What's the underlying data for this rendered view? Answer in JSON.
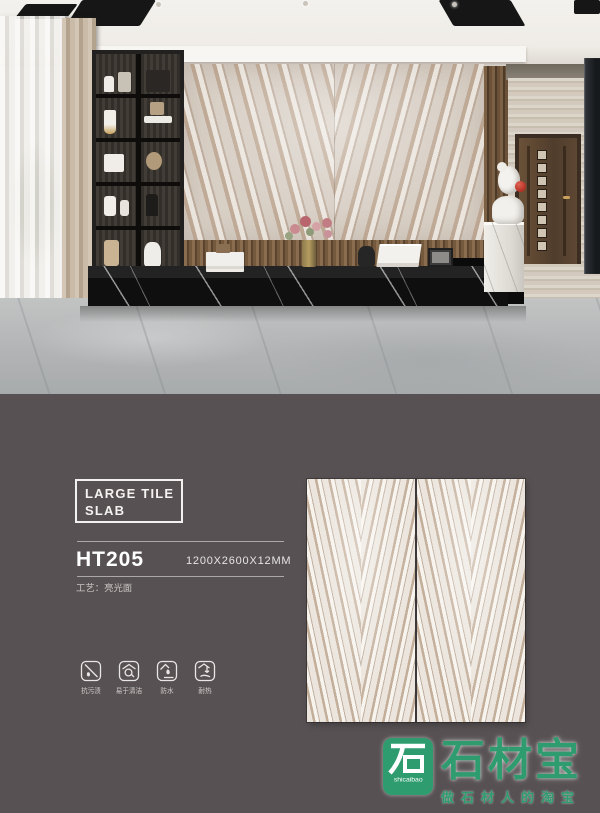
{
  "colors": {
    "panel_background": "#575153",
    "brand_green": "#2e9c6f",
    "text_white": "#f4f3f1",
    "marble_beige": "#d8cfc5",
    "bench_black": "#0f0f0f"
  },
  "product": {
    "series_line1": "LARGE TILE",
    "series_line2": "SLAB",
    "model": "HT205",
    "size": "1200X2600X12MM",
    "process": "工艺：亮光面"
  },
  "features": [
    {
      "name": "anti-stain",
      "label": "抗污渍"
    },
    {
      "name": "easy-clean",
      "label": "易于清洁"
    },
    {
      "name": "waterproof",
      "label": "防水"
    },
    {
      "name": "heat-resistant",
      "label": "耐热"
    }
  ],
  "brand": {
    "name": "石材宝",
    "latin": "shicaibao",
    "tagline": "做石材人的淘宝"
  }
}
